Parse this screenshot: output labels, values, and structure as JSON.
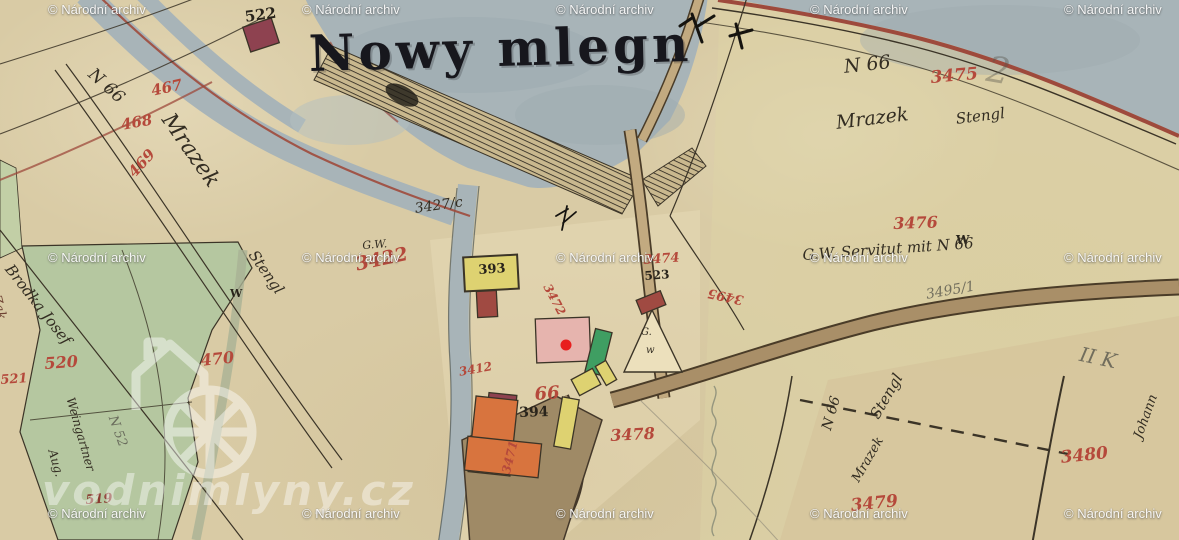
{
  "map": {
    "title": {
      "text": "Nowy mlegn",
      "x": 308,
      "y": 24,
      "size": 50
    },
    "archive_watermark": {
      "text": "© Národní archiv",
      "cols": [
        48,
        302,
        556,
        810,
        1064
      ],
      "rows": [
        2,
        250,
        506
      ]
    },
    "site_watermark": {
      "text": "vodnimlyny.cz",
      "x": 42,
      "y": 466,
      "size": 42
    },
    "marker": {
      "x": 566,
      "y": 345,
      "r": 5.5,
      "color": "#e81e1e"
    },
    "colors": {
      "parchment": "#d9cba5",
      "water": "#a8b4b8",
      "green_parcel": "#b5c7a0",
      "road": "#a98f68",
      "red_number": "#b5493b",
      "ink": "#29241b",
      "pencil": "#6f6a5f",
      "boundary_red": "#9e4a3c",
      "building_red": "#a04a42",
      "building_dark_red": "#8e4250",
      "building_yellow": "#ded271",
      "building_green": "#3f9e62",
      "building_orange": "#d8743e",
      "building_pink": "#e6b4ae"
    },
    "labels": [
      {
        "text": "522",
        "x": 244,
        "y": 10,
        "cls": "ink",
        "size": 15,
        "rot": -8
      },
      {
        "text": "N 66",
        "x": 96,
        "y": 66,
        "cls": "script",
        "size": 17,
        "rot": 42
      },
      {
        "text": "467",
        "x": 150,
        "y": 84,
        "cls": "red",
        "size": 15,
        "rot": -12
      },
      {
        "text": "468",
        "x": 120,
        "y": 118,
        "cls": "red",
        "size": 15,
        "rot": -10
      },
      {
        "text": "469",
        "x": 126,
        "y": 170,
        "cls": "red",
        "size": 15,
        "rot": -48
      },
      {
        "text": "Mrazek",
        "x": 175,
        "y": 110,
        "cls": "script",
        "size": 22,
        "rot": 55
      },
      {
        "text": "Stengl",
        "x": 258,
        "y": 248,
        "cls": "script",
        "size": 15,
        "rot": 55
      },
      {
        "text": "W",
        "x": 230,
        "y": 288,
        "cls": "ink",
        "size": 11,
        "rot": 0
      },
      {
        "text": "470",
        "x": 200,
        "y": 353,
        "cls": "red",
        "size": 16,
        "rot": -6
      },
      {
        "text": "520",
        "x": 44,
        "y": 356,
        "cls": "red",
        "size": 16,
        "rot": -4
      },
      {
        "text": "521",
        "x": 0,
        "y": 374,
        "cls": "red",
        "size": 13,
        "rot": -4
      },
      {
        "text": "519",
        "x": 85,
        "y": 494,
        "cls": "red-dark",
        "size": 13,
        "rot": -4
      },
      {
        "text": "Brodka Josef",
        "x": 14,
        "y": 262,
        "cls": "script",
        "size": 15,
        "rot": 52
      },
      {
        "text": "Weingartner",
        "x": 76,
        "y": 396,
        "cls": "script",
        "size": 12,
        "rot": 74
      },
      {
        "text": "Aug.",
        "x": 58,
        "y": 448,
        "cls": "script",
        "size": 12,
        "rot": 74
      },
      {
        "text": "N 52",
        "x": 118,
        "y": 414,
        "cls": "pencil",
        "size": 13,
        "rot": 70
      },
      {
        "text": "Zak",
        "x": 2,
        "y": 294,
        "cls": "script-brown",
        "size": 13,
        "rot": 76
      },
      {
        "text": "G.W.",
        "x": 362,
        "y": 240,
        "cls": "script",
        "size": 11,
        "rot": -4
      },
      {
        "text": "3422",
        "x": 354,
        "y": 256,
        "cls": "red",
        "size": 19,
        "rot": -12
      },
      {
        "text": "3427/c",
        "x": 414,
        "y": 202,
        "cls": "script",
        "size": 14,
        "rot": -8
      },
      {
        "text": "393",
        "x": 478,
        "y": 264,
        "cls": "ink",
        "size": 13,
        "rot": -4
      },
      {
        "text": "3472",
        "x": 552,
        "y": 282,
        "cls": "red",
        "size": 12,
        "rot": 62
      },
      {
        "text": "3412",
        "x": 458,
        "y": 366,
        "cls": "red",
        "size": 12,
        "rot": -10
      },
      {
        "text": "66",
        "x": 534,
        "y": 386,
        "cls": "red",
        "size": 18,
        "rot": -4
      },
      {
        "text": "394",
        "x": 519,
        "y": 406,
        "cls": "ink",
        "size": 14,
        "rot": -2
      },
      {
        "text": "3474",
        "x": 643,
        "y": 254,
        "cls": "red",
        "size": 13,
        "rot": -4
      },
      {
        "text": "523",
        "x": 644,
        "y": 270,
        "cls": "ink",
        "size": 12,
        "rot": -4
      },
      {
        "text": "G.",
        "x": 641,
        "y": 328,
        "cls": "script",
        "size": 10,
        "rot": 0
      },
      {
        "text": "w",
        "x": 646,
        "y": 346,
        "cls": "script",
        "size": 10,
        "rot": 0
      },
      {
        "text": "3478",
        "x": 610,
        "y": 428,
        "cls": "red",
        "size": 16,
        "rot": -3
      },
      {
        "text": "3471",
        "x": 500,
        "y": 472,
        "cls": "red",
        "size": 12,
        "rot": -76
      },
      {
        "text": "N 66",
        "x": 843,
        "y": 58,
        "cls": "script",
        "size": 19,
        "rot": -6
      },
      {
        "text": "3475",
        "x": 930,
        "y": 70,
        "cls": "red",
        "size": 17,
        "rot": -5
      },
      {
        "text": "Mrazek",
        "x": 835,
        "y": 114,
        "cls": "script",
        "size": 19,
        "rot": -7
      },
      {
        "text": "Stengl",
        "x": 955,
        "y": 112,
        "cls": "script",
        "size": 15,
        "rot": -7
      },
      {
        "text": "3476",
        "x": 893,
        "y": 216,
        "cls": "red",
        "size": 16,
        "rot": -2
      },
      {
        "text": "W",
        "x": 956,
        "y": 234,
        "cls": "ink",
        "size": 12,
        "rot": 0
      },
      {
        "text": "G.W. Servitut mit N 66",
        "x": 802,
        "y": 248,
        "cls": "script",
        "size": 15,
        "rot": -4
      },
      {
        "text": "3495/1",
        "x": 925,
        "y": 288,
        "cls": "pencil",
        "size": 14,
        "rot": -10
      },
      {
        "text": "3495",
        "x": 742,
        "y": 306,
        "cls": "red",
        "size": 13,
        "rot": 192
      },
      {
        "text": "II K",
        "x": 1082,
        "y": 344,
        "cls": "pencil",
        "size": 20,
        "rot": 12
      },
      {
        "text": "2",
        "x": 990,
        "y": 52,
        "cls": "pencil-faint",
        "size": 36,
        "rot": 10
      },
      {
        "text": "N 66",
        "x": 820,
        "y": 428,
        "cls": "script",
        "size": 14,
        "rot": -74
      },
      {
        "text": "Stengl",
        "x": 868,
        "y": 414,
        "cls": "script",
        "size": 15,
        "rot": -60
      },
      {
        "text": "Mrazek",
        "x": 850,
        "y": 478,
        "cls": "script",
        "size": 13,
        "rot": -60
      },
      {
        "text": "3479",
        "x": 850,
        "y": 498,
        "cls": "red",
        "size": 17,
        "rot": -6
      },
      {
        "text": "3480",
        "x": 1060,
        "y": 450,
        "cls": "red",
        "size": 17,
        "rot": -6
      },
      {
        "text": "Johann",
        "x": 1132,
        "y": 436,
        "cls": "script",
        "size": 13,
        "rot": -70
      }
    ],
    "buildings": [
      {
        "x": 246,
        "y": 22,
        "w": 30,
        "h": 26,
        "rot": -18,
        "fill": "#8e4250"
      },
      {
        "x": 464,
        "y": 256,
        "w": 54,
        "h": 34,
        "rot": -3,
        "fill": "#ded271",
        "sw": 2
      },
      {
        "x": 477,
        "y": 291,
        "w": 20,
        "h": 26,
        "rot": -3,
        "fill": "#a04a42"
      },
      {
        "x": 536,
        "y": 318,
        "w": 54,
        "h": 44,
        "rot": -2,
        "fill": "#e6b4ae"
      },
      {
        "x": 590,
        "y": 330,
        "w": 17,
        "h": 44,
        "rot": 14,
        "fill": "#3f9e62"
      },
      {
        "x": 638,
        "y": 295,
        "w": 26,
        "h": 15,
        "rot": -22,
        "fill": "#a04a42"
      },
      {
        "x": 574,
        "y": 373,
        "w": 24,
        "h": 18,
        "rot": -28,
        "fill": "#ded271"
      },
      {
        "x": 558,
        "y": 398,
        "w": 17,
        "h": 50,
        "rot": 10,
        "fill": "#ded271"
      },
      {
        "x": 600,
        "y": 362,
        "w": 12,
        "h": 22,
        "rot": -30,
        "fill": "#ded271"
      },
      {
        "x": 488,
        "y": 394,
        "w": 28,
        "h": 18,
        "rot": 6,
        "fill": "#8e4250"
      },
      {
        "x": 472,
        "y": 398,
        "w": 42,
        "h": 76,
        "rot": 6,
        "fill": "#d8743e"
      },
      {
        "x": 466,
        "y": 440,
        "w": 74,
        "h": 34,
        "rot": 6,
        "fill": "#d8743e"
      }
    ]
  }
}
